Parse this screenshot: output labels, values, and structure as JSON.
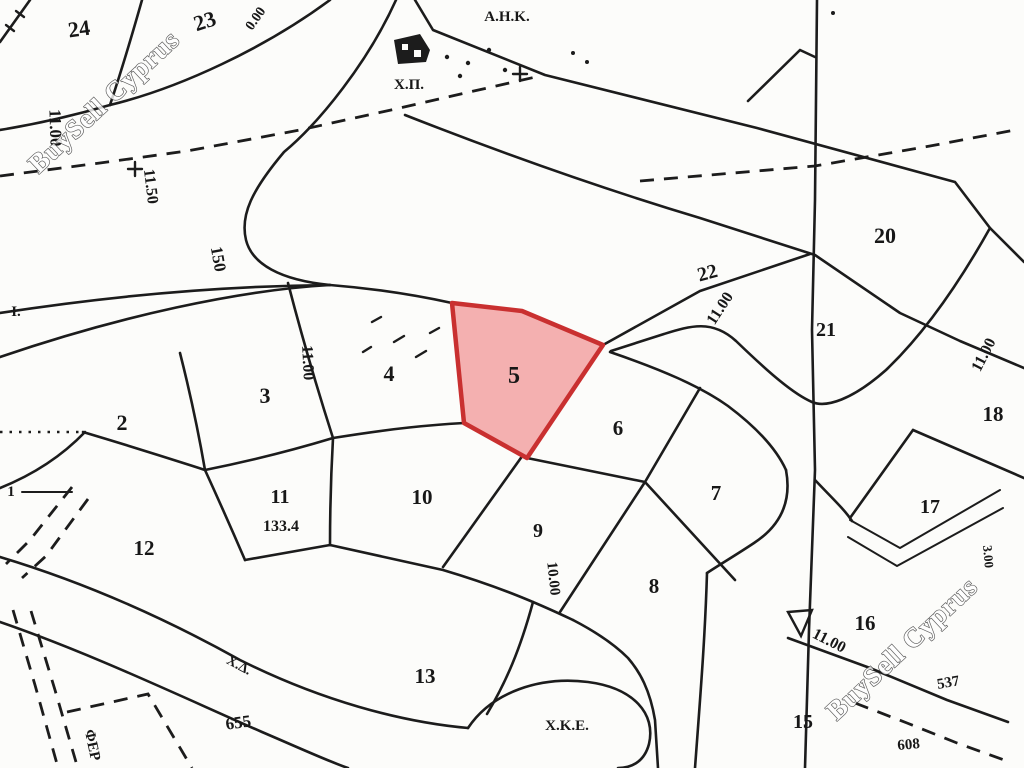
{
  "map": {
    "type": "cadastral-parcel-plan",
    "background_color": "#fcfcfa",
    "line_color": "#1c1c1c",
    "highlighted_parcel": {
      "number": "5",
      "points": "452,303 522,311 603,345 527,458 464,423",
      "fill": "#f2a2a2",
      "fill_opacity": "0.85",
      "stroke": "#c93030",
      "stroke_width": "4.5"
    },
    "watermarks": [
      {
        "text": "BuySell Cyprus",
        "x": 110,
        "y": 108,
        "rot": -43,
        "size": 27,
        "fill": "#ffffff",
        "outline": "#3a3a3a",
        "opacity": 0.8
      },
      {
        "text": "BuySell Cyprus",
        "x": 908,
        "y": 655,
        "rot": -43,
        "size": 27,
        "fill": "#ffffff",
        "outline": "#3a3a3a",
        "opacity": 0.8
      }
    ],
    "labels": [
      {
        "kind": "parcel",
        "text": "24",
        "x": 80,
        "y": 36,
        "rot": -8,
        "size": 22
      },
      {
        "kind": "parcel",
        "text": "23",
        "x": 207,
        "y": 28,
        "rot": -18,
        "size": 22
      },
      {
        "kind": "parcel",
        "text": "2",
        "x": 122,
        "y": 430,
        "rot": 0,
        "size": 22
      },
      {
        "kind": "parcel",
        "text": "3",
        "x": 265,
        "y": 403,
        "rot": 0,
        "size": 22
      },
      {
        "kind": "parcel",
        "text": "4",
        "x": 389,
        "y": 381,
        "rot": 0,
        "size": 22
      },
      {
        "kind": "parcel",
        "text": "5",
        "x": 514,
        "y": 383,
        "rot": 0,
        "size": 24
      },
      {
        "kind": "parcel",
        "text": "6",
        "x": 618,
        "y": 435,
        "rot": 0,
        "size": 21
      },
      {
        "kind": "parcel",
        "text": "7",
        "x": 716,
        "y": 500,
        "rot": 0,
        "size": 21
      },
      {
        "kind": "parcel",
        "text": "8",
        "x": 654,
        "y": 593,
        "rot": 0,
        "size": 21
      },
      {
        "kind": "parcel",
        "text": "9",
        "x": 538,
        "y": 537,
        "rot": 0,
        "size": 20
      },
      {
        "kind": "parcel",
        "text": "10",
        "x": 422,
        "y": 504,
        "rot": 0,
        "size": 21
      },
      {
        "kind": "parcel",
        "text": "11",
        "x": 280,
        "y": 503,
        "rot": 0,
        "size": 20
      },
      {
        "kind": "parcel",
        "text": "12",
        "x": 144,
        "y": 555,
        "rot": 0,
        "size": 21
      },
      {
        "kind": "parcel",
        "text": "13",
        "x": 425,
        "y": 683,
        "rot": 0,
        "size": 21
      },
      {
        "kind": "parcel",
        "text": "15",
        "x": 803,
        "y": 728,
        "rot": 0,
        "size": 20
      },
      {
        "kind": "parcel",
        "text": "16",
        "x": 865,
        "y": 630,
        "rot": 0,
        "size": 21
      },
      {
        "kind": "parcel",
        "text": "17",
        "x": 930,
        "y": 513,
        "rot": 0,
        "size": 20
      },
      {
        "kind": "parcel",
        "text": "18",
        "x": 993,
        "y": 421,
        "rot": 0,
        "size": 21
      },
      {
        "kind": "parcel",
        "text": "20",
        "x": 885,
        "y": 243,
        "rot": 0,
        "size": 22
      },
      {
        "kind": "parcel",
        "text": "21",
        "x": 826,
        "y": 336,
        "rot": 0,
        "size": 20
      },
      {
        "kind": "parcel",
        "text": "22",
        "x": 709,
        "y": 279,
        "rot": -15,
        "size": 20
      },
      {
        "kind": "dimension",
        "text": "11.00",
        "x": 50,
        "y": 128,
        "rot": 88,
        "size": 17
      },
      {
        "kind": "dimension",
        "text": "11.50",
        "x": 146,
        "y": 187,
        "rot": 83,
        "size": 16
      },
      {
        "kind": "dimension",
        "text": "150",
        "x": 213,
        "y": 260,
        "rot": 80,
        "size": 17
      },
      {
        "kind": "dimension",
        "text": "0.00",
        "x": 259,
        "y": 21,
        "rot": -55,
        "size": 14
      },
      {
        "kind": "dimension",
        "text": "11.00",
        "x": 303,
        "y": 363,
        "rot": 87,
        "size": 16
      },
      {
        "kind": "dimension",
        "text": "10.00",
        "x": 549,
        "y": 579,
        "rot": 84,
        "size": 15
      },
      {
        "kind": "dimension",
        "text": "11.00",
        "x": 724,
        "y": 311,
        "rot": -57,
        "size": 16
      },
      {
        "kind": "dimension",
        "text": "11.00",
        "x": 988,
        "y": 357,
        "rot": -63,
        "size": 16
      },
      {
        "kind": "dimension",
        "text": "11.00",
        "x": 827,
        "y": 645,
        "rot": 27,
        "size": 16
      },
      {
        "kind": "dimension",
        "text": "3.00",
        "x": 984,
        "y": 557,
        "rot": 85,
        "size": 13
      },
      {
        "kind": "dimension",
        "text": "133.4",
        "x": 281,
        "y": 531,
        "rot": 0,
        "size": 16
      },
      {
        "kind": "ref",
        "text": "537",
        "x": 949,
        "y": 687,
        "rot": -10,
        "size": 15
      },
      {
        "kind": "ref",
        "text": "608",
        "x": 909,
        "y": 749,
        "rot": -5,
        "size": 15
      },
      {
        "kind": "ref",
        "text": "655",
        "x": 239,
        "y": 728,
        "rot": -8,
        "size": 17
      },
      {
        "kind": "landmark",
        "text": "Α.Η.Κ.",
        "x": 507,
        "y": 21,
        "rot": 0,
        "size": 15
      },
      {
        "kind": "landmark",
        "text": "Χ.Π.",
        "x": 409,
        "y": 89,
        "rot": 0,
        "size": 15
      },
      {
        "kind": "landmark",
        "text": "Χ.Δ.",
        "x": 237,
        "y": 669,
        "rot": 28,
        "size": 14
      },
      {
        "kind": "landmark",
        "text": "Χ.Κ.Ε.",
        "x": 567,
        "y": 730,
        "rot": 0,
        "size": 15
      },
      {
        "kind": "landmark",
        "text": "Ι.",
        "x": 16,
        "y": 316,
        "rot": 0,
        "size": 15
      },
      {
        "kind": "landmark",
        "text": "ΦΕΡ",
        "x": 88,
        "y": 746,
        "rot": 78,
        "size": 15
      },
      {
        "kind": "ref",
        "text": "1",
        "x": 11,
        "y": 496,
        "rot": 0,
        "size": 15
      }
    ]
  }
}
